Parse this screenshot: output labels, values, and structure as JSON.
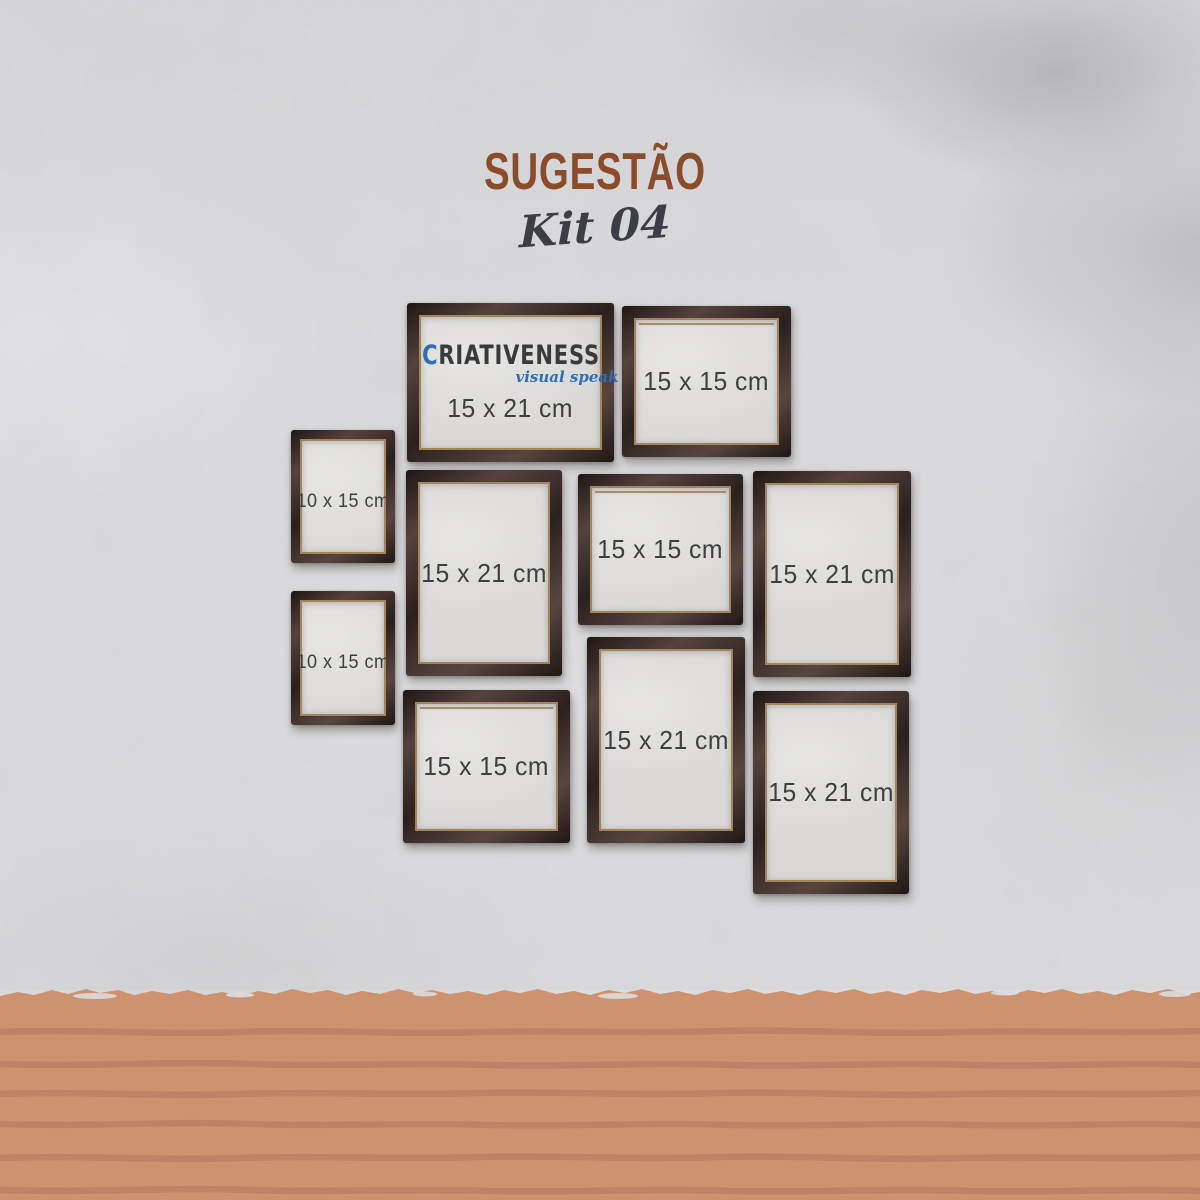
{
  "title": "SUGESTÃO",
  "subtitle": "Kit 04",
  "logo": {
    "brand": "CRIATIVENESS",
    "tagline": "visual speak"
  },
  "frames": [
    {
      "label": "15 x 21 cm",
      "size": "15x21",
      "orientation": "landscape",
      "has_logo": true
    },
    {
      "label": "15 x 15 cm",
      "size": "15x15",
      "orientation": "square"
    },
    {
      "label": "10 x 15 cm",
      "size": "10x15",
      "orientation": "portrait"
    },
    {
      "label": "10 x 15 cm",
      "size": "10x15",
      "orientation": "portrait"
    },
    {
      "label": "15 x 21 cm",
      "size": "15x21",
      "orientation": "portrait"
    },
    {
      "label": "15 x 15 cm",
      "size": "15x15",
      "orientation": "square"
    },
    {
      "label": "15 x 21 cm",
      "size": "15x21",
      "orientation": "portrait"
    },
    {
      "label": "15 x 15 cm",
      "size": "15x15",
      "orientation": "square"
    },
    {
      "label": "15 x 21 cm",
      "size": "15x21",
      "orientation": "portrait"
    },
    {
      "label": "15 x 21 cm",
      "size": "15x21",
      "orientation": "portrait"
    }
  ],
  "colors": {
    "title_brown": "#8b4c2c",
    "subtitle_gray": "#3b3e44",
    "wall_gray": "#dcdcde",
    "floor_terracotta": "#cd9370",
    "floor_plank_line": "#ba8166",
    "frame_wood_dark": "#382b28",
    "frame_gold_trim": "#a3835a",
    "label_text": "#3e3e3e",
    "logo_dark": "#3a3a3a",
    "logo_blue": "#2f6db5"
  }
}
